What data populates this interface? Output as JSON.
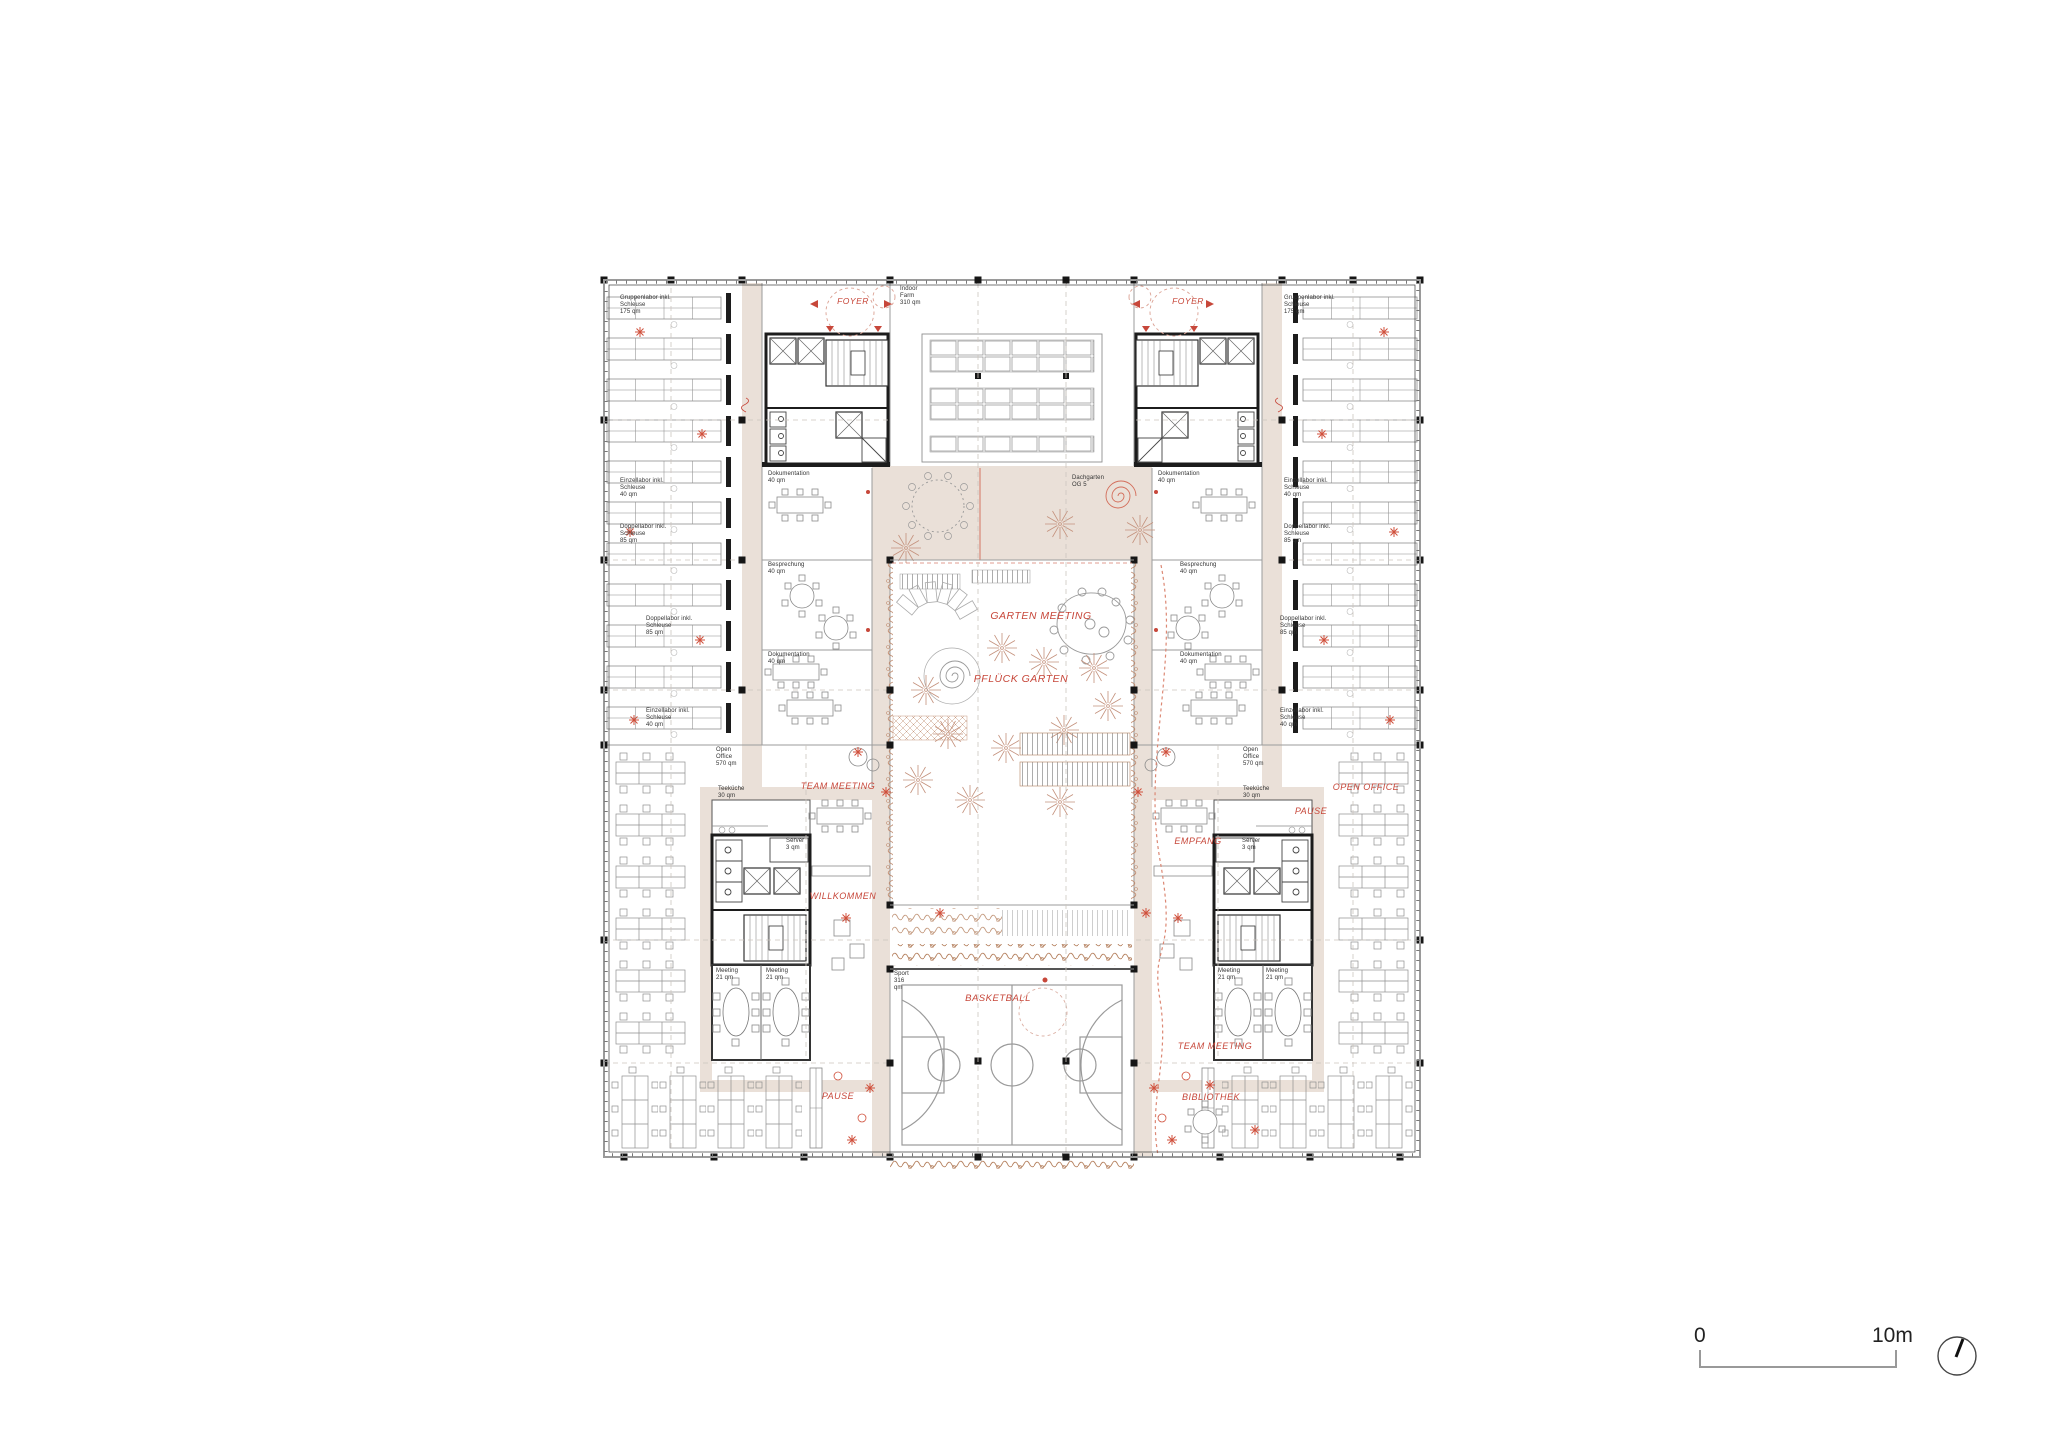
{
  "plan_type": "architectural floor plan",
  "colors": {
    "accent_red": "#c7473a",
    "zone_pink": "#eae0d8",
    "plant_brown": "#b5815f",
    "wall_black": "#1c1c1c"
  },
  "red_labels": [
    {
      "id": "foyer-left",
      "text": "FOYER"
    },
    {
      "id": "foyer-right",
      "text": "FOYER"
    },
    {
      "id": "garten-meeting",
      "text": "GARTEN MEETING"
    },
    {
      "id": "pflueck-garten",
      "text": "PFLÜCK GARTEN"
    },
    {
      "id": "team-meeting-left",
      "text": "TEAM MEETING"
    },
    {
      "id": "open-office-right",
      "text": "OPEN OFFICE"
    },
    {
      "id": "pause-right",
      "text": "PAUSE"
    },
    {
      "id": "empfang",
      "text": "EMPFANG"
    },
    {
      "id": "willkommen",
      "text": "WILLKOMMEN"
    },
    {
      "id": "basketball",
      "text": "BASKETBALL"
    },
    {
      "id": "team-meeting-right",
      "text": "TEAM MEETING"
    },
    {
      "id": "pause-left",
      "text": "PAUSE"
    },
    {
      "id": "bibliothek",
      "text": "BIBLIOTHEK"
    }
  ],
  "room_labels": [
    {
      "text": "Gruppenlabor inkl.\nSchleuse\n175 qm"
    },
    {
      "text": "Einzellabor inkl.\nSchleuse\n40 qm"
    },
    {
      "text": "Doppellabor inkl.\nSchleuse\n85 qm"
    },
    {
      "text": "Doppellabor inkl.\nSchleuse\n85 qm"
    },
    {
      "text": "Einzellabor inkl.\nSchleuse\n40 qm"
    },
    {
      "text": "Dokumentation\n40 qm"
    },
    {
      "text": "Besprechung\n40 qm"
    },
    {
      "text": "Dokumentation\n40 qm"
    },
    {
      "text": "Open\nOffice\n570 qm"
    },
    {
      "text": "Teeküche\n30 qm"
    },
    {
      "text": "Server\n3 qm"
    },
    {
      "text": "Meeting\n21 qm"
    },
    {
      "text": "Meeting\n21 qm"
    },
    {
      "text": "Indoor\nFarm\n310 qm"
    },
    {
      "text": "Dachgarten\nOG 5"
    },
    {
      "text": "Sport\n316\nqm"
    },
    {
      "text": "Gruppenlabor inkl.\nSchleuse\n175 qm"
    },
    {
      "text": "Einzellabor inkl.\nSchleuse\n40 qm"
    },
    {
      "text": "Doppellabor inkl.\nSchleuse\n85 qm"
    },
    {
      "text": "Doppellabor inkl.\nSchleuse\n85 qm"
    },
    {
      "text": "Einzellabor inkl.\nSchleuse\n40 qm"
    },
    {
      "text": "Dokumentation\n40 qm"
    },
    {
      "text": "Besprechung\n40 qm"
    },
    {
      "text": "Dokumentation\n40 qm"
    },
    {
      "text": "Open\nOffice\n570 qm"
    },
    {
      "text": "Teeküche\n30 qm"
    },
    {
      "text": "Server\n3 qm"
    },
    {
      "text": "Meeting\n21 qm"
    },
    {
      "text": "Meeting\n21 qm"
    }
  ],
  "scale_bar": {
    "start": "0",
    "end": "10m"
  }
}
